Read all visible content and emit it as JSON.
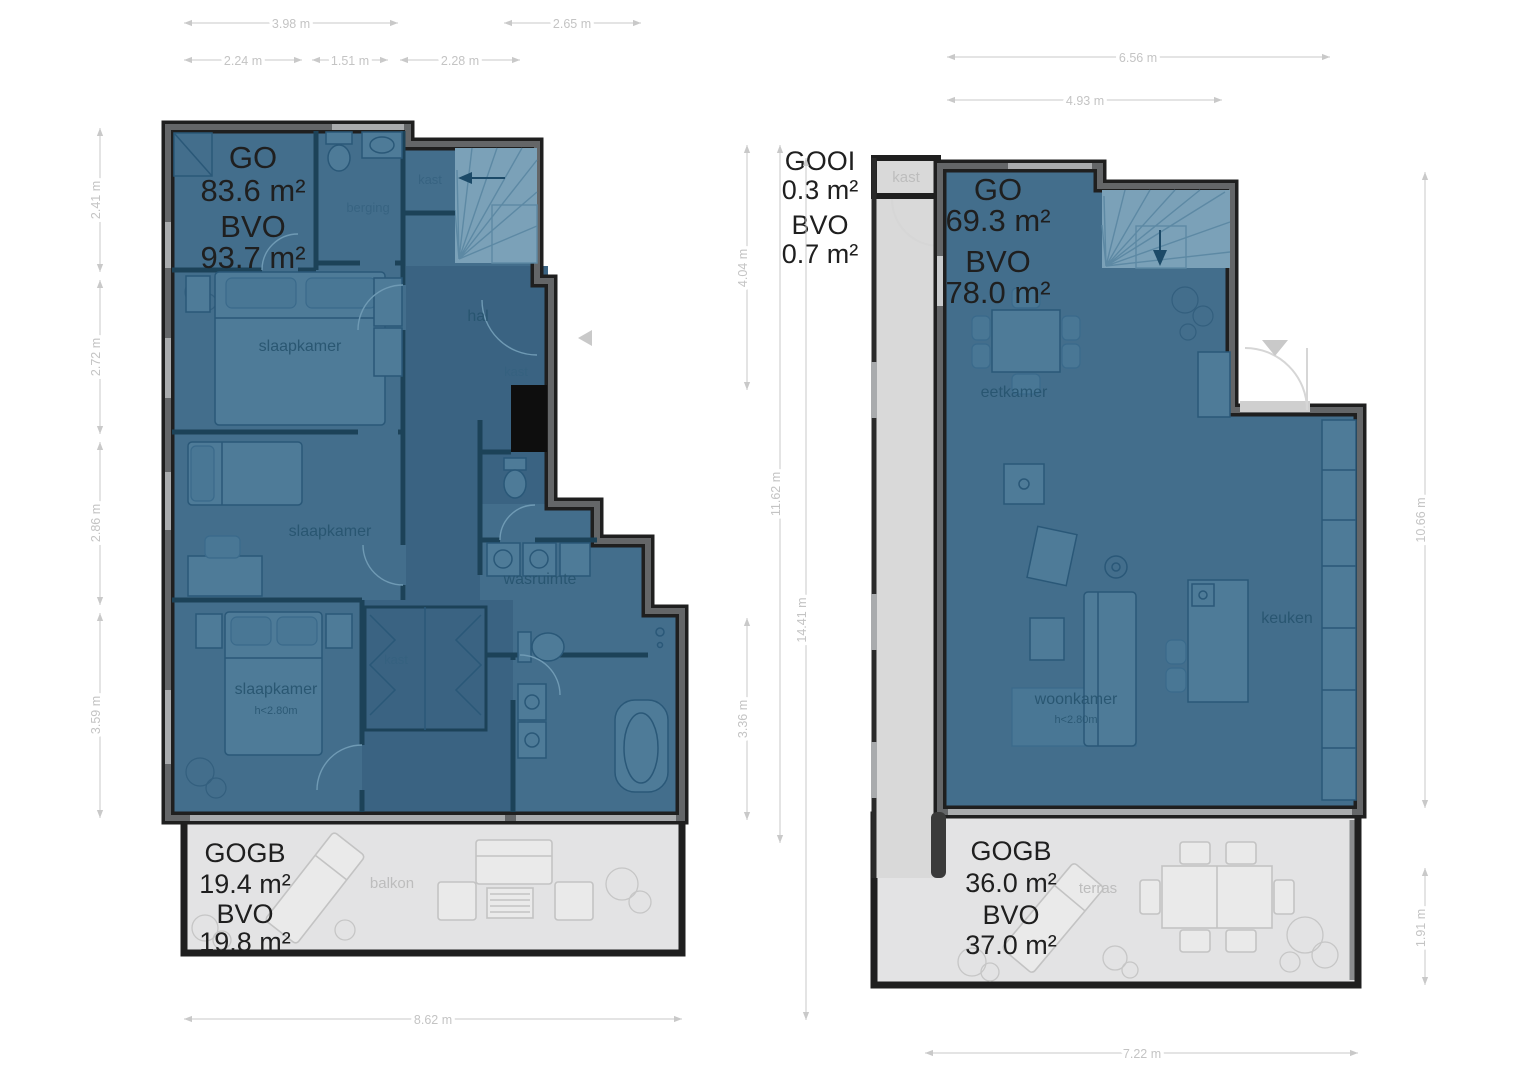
{
  "left": {
    "area": [
      "GO",
      "83.6 m²",
      "BVO",
      "93.7 m²"
    ],
    "balcony_area": [
      "GOGB",
      "19.4 m²",
      "BVO",
      "19.8 m²"
    ],
    "rooms": {
      "storage": "berging",
      "closet_top": "kast",
      "hall": "hal",
      "closet_shaft": "kast",
      "closet_wardrobe": "kast",
      "bedroom1": "slaapkamer",
      "bedroom2": "slaapkamer",
      "bedroom3": "slaapkamer",
      "bedroom3_height": "h<2.80m",
      "laundry": "wasruimte",
      "balcony": "balkon"
    },
    "dims": {
      "top_row1": [
        "3.98 m",
        "2.65 m"
      ],
      "top_row2": [
        "2.24 m",
        "1.51 m",
        "2.28 m"
      ],
      "left_col": [
        "2.41 m",
        "2.72 m",
        "2.86 m",
        "3.59 m"
      ],
      "bottom": "8.62 m"
    }
  },
  "right": {
    "outside_area": [
      "GOOI",
      "0.3 m²",
      "BVO",
      "0.7 m²"
    ],
    "area": [
      "GO",
      "69.3 m²",
      "BVO",
      "78.0 m²"
    ],
    "terrace_area": [
      "GOGB",
      "36.0 m²",
      "BVO",
      "37.0 m²"
    ],
    "rooms": {
      "closet": "kast",
      "dining": "eetkamer",
      "living": "woonkamer",
      "living_height": "h<2.80m",
      "kitchen": "keuken",
      "terrace": "terras"
    },
    "dims": {
      "top_row1": "6.56 m",
      "top_row2": "4.93 m",
      "mid_col": [
        "4.04 m",
        "11.62 m",
        "14.41 m",
        "3.36 m"
      ],
      "right_col": [
        "10.66 m",
        "1.91 m"
      ],
      "bottom": "7.22 m"
    }
  },
  "colors": {
    "floor_fill": "#436e8c",
    "hall_fill": "#3a6382",
    "stairs_fill": "#7ba1b8",
    "wall_black": "#1f1f1f",
    "wall_gray": "#646668",
    "window_gray": "#a9abad",
    "outdoor_fill": "#e3e3e4",
    "area_text": "#1f1f1f",
    "room_text": "#27546f",
    "outdoor_text": "#bdbdbd",
    "dimension_gray": "#c9c9c9"
  }
}
